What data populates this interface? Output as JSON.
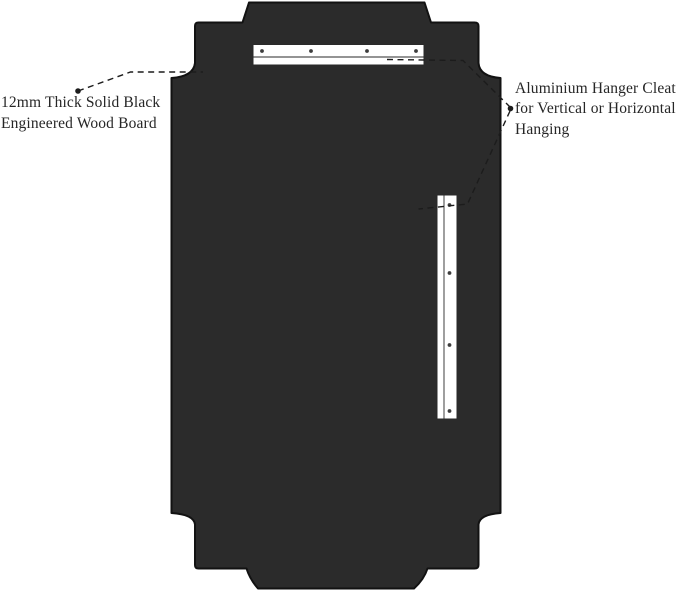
{
  "colors": {
    "background": "#ffffff",
    "board_fill": "#2b2b2b",
    "board_outline": "#121212",
    "cleat_fill": "#ffffff",
    "cleat_outline": "#2a2a2a",
    "screw_color": "#3d3d3d",
    "leader_color": "#1c1c1c",
    "text_color": "#262626"
  },
  "annotations": {
    "board": {
      "full_text": "12mm Thick Solid Black Engineered Wood Board",
      "line1": "12mm Thick Solid Black",
      "line2": "Engineered Wood Board"
    },
    "cleat": {
      "full_text": "Aluminium Hanger Cleat for Vertical or Horizontal Hanging",
      "line1": "Aluminium Hanger Cleat",
      "line2": "for Vertical or Horizontal",
      "line3": "Hanging"
    }
  },
  "graphics": {
    "board": "engineered-wood-board-back-view",
    "horizontal_cleat": "aluminium-hanger-cleat-horizontal",
    "vertical_cleat": "aluminium-hanger-cleat-vertical",
    "horizontal_cleat_screw_count": 4,
    "vertical_cleat_screw_count": 4
  }
}
